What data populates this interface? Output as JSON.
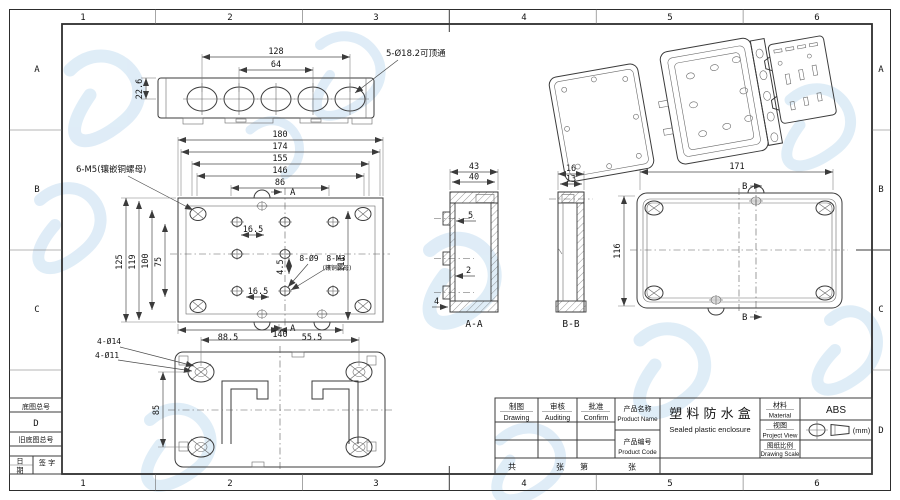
{
  "sheet": {
    "background": "#ffffff",
    "line_color": "#3b3b3b",
    "watermark_color": "#b9d7ee"
  },
  "grid": {
    "cols": [
      "1",
      "2",
      "3",
      "4",
      "5",
      "6"
    ],
    "rows_left": [
      "A",
      "B",
      "C"
    ],
    "rows_right": [
      "A",
      "B",
      "C",
      "D"
    ]
  },
  "left_block": {
    "base_no_label": "底图总号",
    "row_letter": "D",
    "old_base_no_label": "旧底图总号",
    "date_char_top": "日",
    "date_char_bottom": "期",
    "sign_label": "签  字"
  },
  "title_block": {
    "drawing_cn": "制图",
    "drawing_en": "Drawing",
    "auditing_cn": "审核",
    "auditing_en": "Auditing",
    "confirm_cn": "批准",
    "confirm_en": "Confirm",
    "product_name_cn": "产品名称",
    "product_name_en": "Product Name",
    "product_code_cn": "产品编号",
    "product_code_en": "Product Code",
    "name_value_cn": "塑 料 防 水 盒",
    "name_value_en": "Sealed plastic enclosure",
    "material_cn": "材料",
    "material_en": "Material",
    "material_value": "ABS",
    "view_cn": "视图",
    "view_en": "Project View",
    "scale_cn": "图纸比例",
    "scale_en": "Drawing Scale",
    "units": "(mm)",
    "sheet_total_prefix": "共",
    "sheet_total_suffix": "张",
    "sheet_no_prefix": "第",
    "sheet_no_suffix": "张"
  },
  "views": {
    "top": {
      "d128": "128",
      "d64": "64",
      "d226": "22.6",
      "hole_note": "5-Ø18.2可顶通"
    },
    "plan": {
      "d180": "180",
      "d174": "174",
      "d155": "155",
      "d146": "146",
      "d86": "86",
      "d125": "125",
      "d119": "119",
      "d100": "100",
      "d75": "75",
      "d165a": "16.5",
      "d45": "4.5",
      "d165b": "16.5",
      "d111": "111",
      "d885": "88.5",
      "d555": "55.5",
      "note_m5": "6-M5(镶嵌铜螺母)",
      "note_89": "8-Ø9",
      "note_m3": "8-M3",
      "note_m3_sub": "(镶铜螺母)",
      "cut_a": "A"
    },
    "back": {
      "note_d14": "4-Ø14",
      "note_d11": "4-Ø11",
      "d140": "140",
      "d85": "85"
    },
    "aa": {
      "d43": "43",
      "d40": "40",
      "d5": "5",
      "d2": "2",
      "d4": "4",
      "label": "A-A"
    },
    "bb": {
      "d16": "16",
      "d13": "13",
      "label": "B-B"
    },
    "right": {
      "d171": "171",
      "d116": "116",
      "cut_b": "B"
    }
  }
}
